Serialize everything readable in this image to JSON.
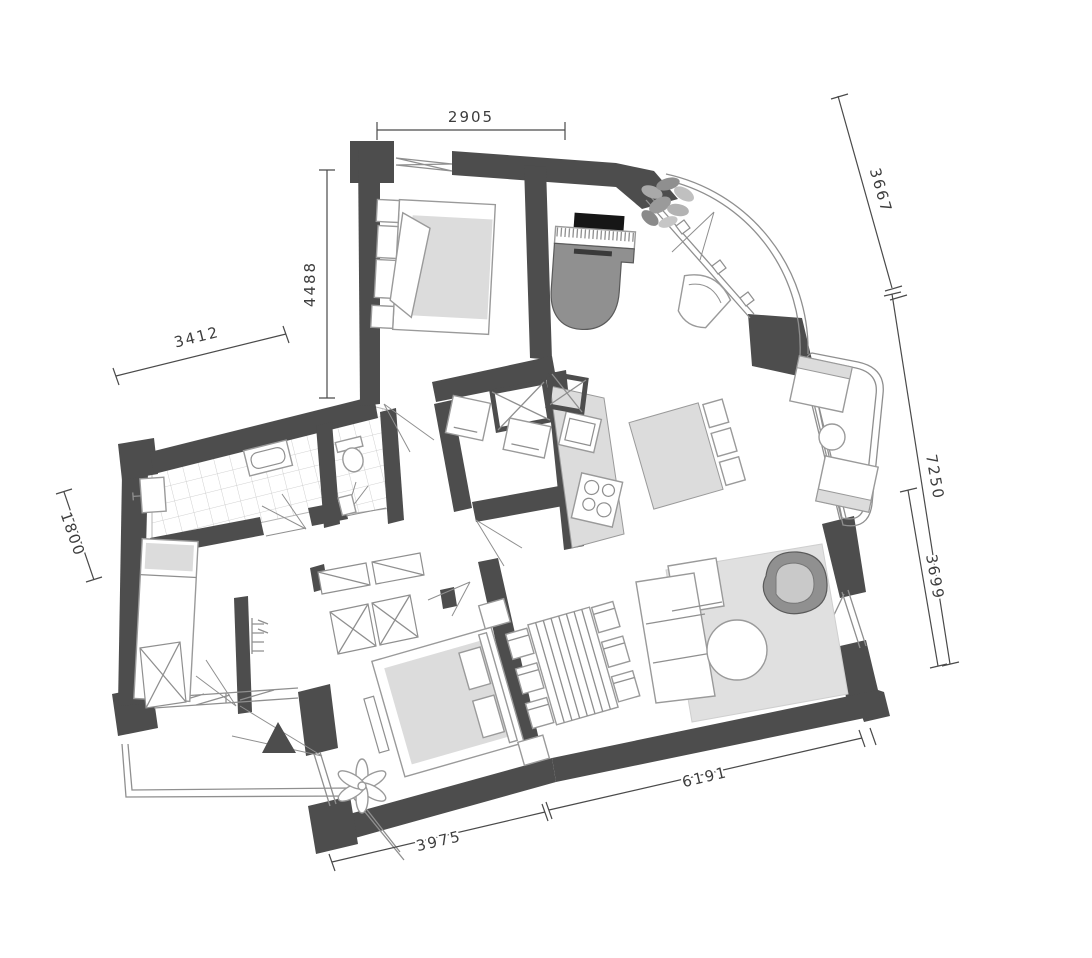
{
  "drawing": {
    "type": "architectural-floor-plan",
    "units": "mm"
  },
  "dimensions": {
    "top": "2905",
    "top_right": "3667",
    "left": "4488",
    "upper_left": "3412",
    "far_left": "1800",
    "right_outer": "7250",
    "right_inner": "3699",
    "bottom_right": "6191",
    "bottom_left": "3975"
  },
  "colors": {
    "bg": "#ffffff",
    "wall": "#4d4d4d",
    "line_light": "#8f8f8f",
    "furn_line": "#9a9a9a",
    "furn_fill": "#dcdcdc",
    "rug": "#e0e0e0",
    "dark": "#161616",
    "mid": "#909090",
    "tile": "#c4c4c4",
    "dim": "#4a4a4a",
    "dim_text": "#3d3d3d"
  },
  "furniture_icons": [
    "double-bed-icon",
    "grand-piano-icon",
    "plant-icon",
    "armchair-icon",
    "balcony-chair-icon",
    "balcony-table-icon",
    "kitchen-counter-icon",
    "sink-icon",
    "hob-icon",
    "kitchen-island-icon",
    "bar-stool-icon",
    "washing-machine-icon",
    "ventilation-shaft-icon",
    "bathtub-icon",
    "wash-basin-icon",
    "toilet-icon",
    "single-bed-icon",
    "wardrobe-icon",
    "dining-table-icon",
    "dining-chair-icon",
    "corner-sofa-icon",
    "coffee-table-icon",
    "rug-icon",
    "sideboard-icon",
    "entrance-arrow-icon",
    "flower-plant-icon",
    "coat-rack-icon"
  ]
}
